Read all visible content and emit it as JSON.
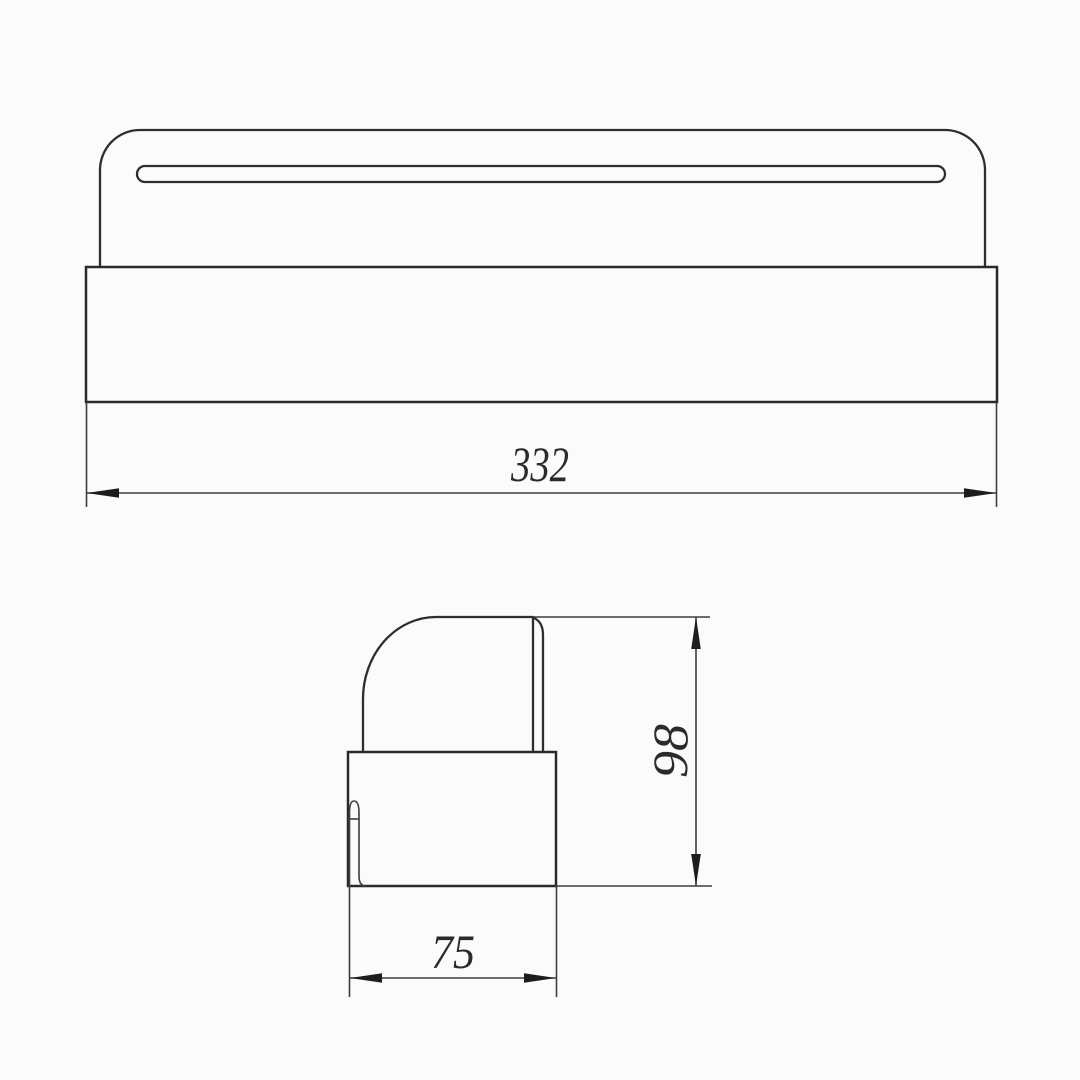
{
  "drawing": {
    "background_color": "#fbfbfb",
    "line_color": "#2e2e2e",
    "views": {
      "front_view": {
        "features": [
          "rounded-top-plate",
          "horizontal-slot",
          "base-block"
        ],
        "dimension": {
          "value": "332",
          "orientation": "horizontal",
          "position": "below"
        }
      },
      "side_view": {
        "features": [
          "round-cornered-cap",
          "right-edge-chamfer",
          "base-block",
          "inner-curl"
        ],
        "dimensions": {
          "height": {
            "value": "98",
            "orientation": "vertical",
            "position": "right"
          },
          "depth": {
            "value": "75",
            "orientation": "horizontal",
            "position": "below"
          }
        }
      }
    },
    "dimensions": {
      "front_width": {
        "value": "332"
      },
      "side_height": {
        "value": "98"
      },
      "side_width": {
        "value": "75"
      }
    }
  }
}
